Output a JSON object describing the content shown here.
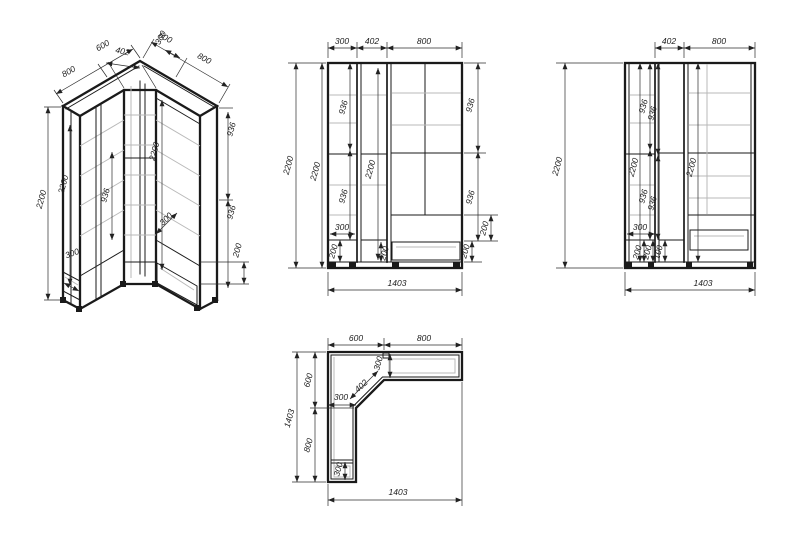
{
  "drawing_type": "corner-wardrobe-technical-drawing",
  "colors": {
    "background": "#ffffff",
    "outline": "#1a1a1a",
    "shelf_line": "#b9b9b9",
    "dimension_text": "#1c1c1c"
  },
  "views": {
    "iso": {
      "name": "isometric-view",
      "dims": {
        "side_800": "800",
        "side_600": "600",
        "top_600": "600",
        "top_402": "402",
        "top_300": "300",
        "top_800": "800",
        "height_2200": "2200",
        "col_2200": "2200",
        "col_936": "936",
        "col_300": "300",
        "mid_2200": "2200",
        "mid_300": "300",
        "right_936_top": "936",
        "right_936_bottom": "936",
        "right_200": "200"
      }
    },
    "front": {
      "name": "front-elevation",
      "dims": {
        "top_300": "300",
        "top_402": "402",
        "top_800": "800",
        "height_2200": "2200",
        "height2_2200": "2200",
        "left_936_top": "936",
        "left_936_bottom": "936",
        "left_300": "300",
        "left_200": "200",
        "mid_2200": "2200",
        "mid_200": "200",
        "right_936_top": "936",
        "right_936_bottom": "936",
        "right_200_top": "200",
        "right_200_bottom": "200",
        "width_1403": "1403"
      }
    },
    "side": {
      "name": "side-elevation",
      "dims": {
        "top_402": "402",
        "top_800": "800",
        "height_2200": "2200",
        "left_2200": "2200",
        "c1_936_top": "936",
        "c1_936_bottom": "936",
        "c2_936_top": "936",
        "c2_936_bottom": "936",
        "right_2200": "2200",
        "small_300": "300",
        "small_200a": "200",
        "small_200b": "200",
        "small_100": "100",
        "width_1403": "1403"
      }
    },
    "plan": {
      "name": "plan-view",
      "dims": {
        "top_600": "600",
        "top_800": "800",
        "left_1403": "1403",
        "left_600": "600",
        "left_800": "800",
        "wing_300": "300",
        "diag_402": "402",
        "mid_300": "300",
        "bottom_300": "300",
        "width_1403": "1403"
      }
    }
  }
}
